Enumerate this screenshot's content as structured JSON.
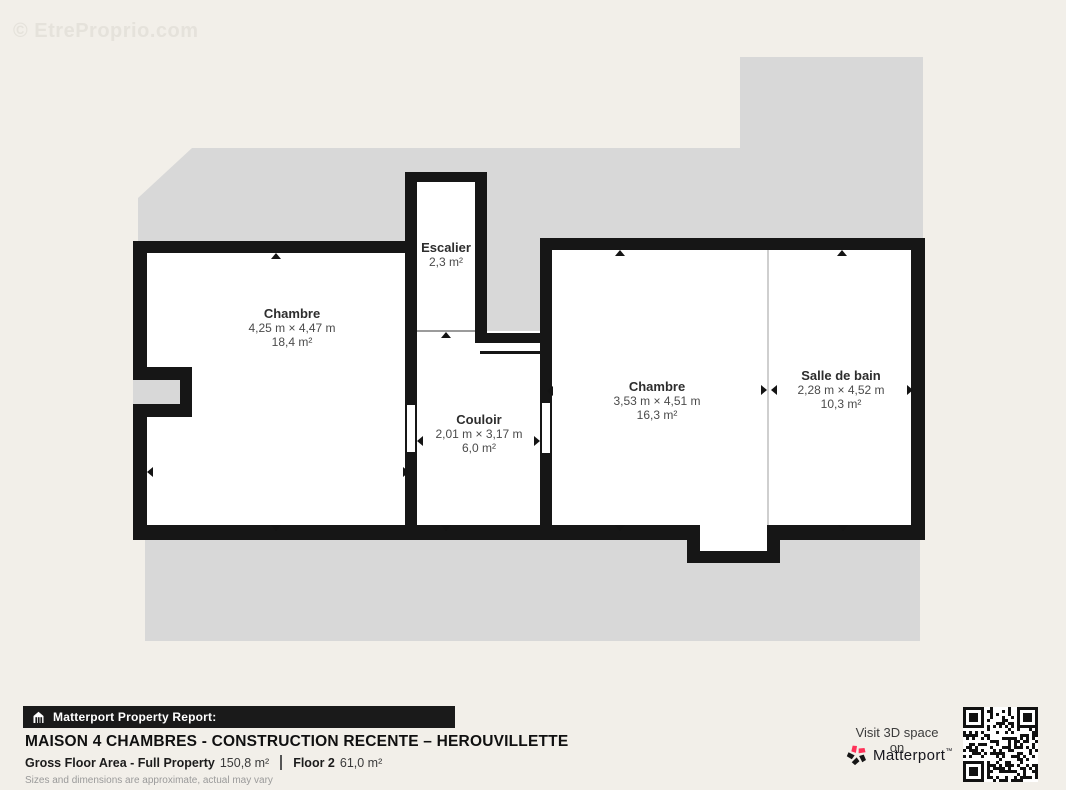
{
  "watermark": "© EtreProprio.com",
  "rooms": [
    {
      "name": "Chambre",
      "dims": "4,25 m × 4,47 m",
      "area": "18,4 m²"
    },
    {
      "name": "Escalier",
      "dims": "",
      "area": "2,3 m²"
    },
    {
      "name": "Couloir",
      "dims": "2,01 m × 3,17 m",
      "area": "6,0 m²"
    },
    {
      "name": "Chambre",
      "dims": "3,53 m × 4,51 m",
      "area": "16,3 m²"
    },
    {
      "name": "Salle de bain",
      "dims": "2,28 m × 4,52 m",
      "area": "10,3 m²"
    }
  ],
  "footer": {
    "report_label": "Matterport Property Report:",
    "title": "MAISON 4 CHAMBRES - CONSTRUCTION RECENTE – HEROUVILLETTE",
    "gross_label": "Gross Floor Area - Full Property",
    "gross_value": "150,8 m²",
    "floor_label": "Floor 2",
    "floor_value": "61,0 m²",
    "disclaimer": "Sizes and dimensions are approximate, actual may vary",
    "visit_label": "Visit 3D space on",
    "brand": "Matterport",
    "brand_mark": "™"
  },
  "colors": {
    "background": "#f2efe9",
    "roof_gray": "#d8d8d8",
    "wall": "#161616",
    "accent_red": "#ff3158"
  }
}
